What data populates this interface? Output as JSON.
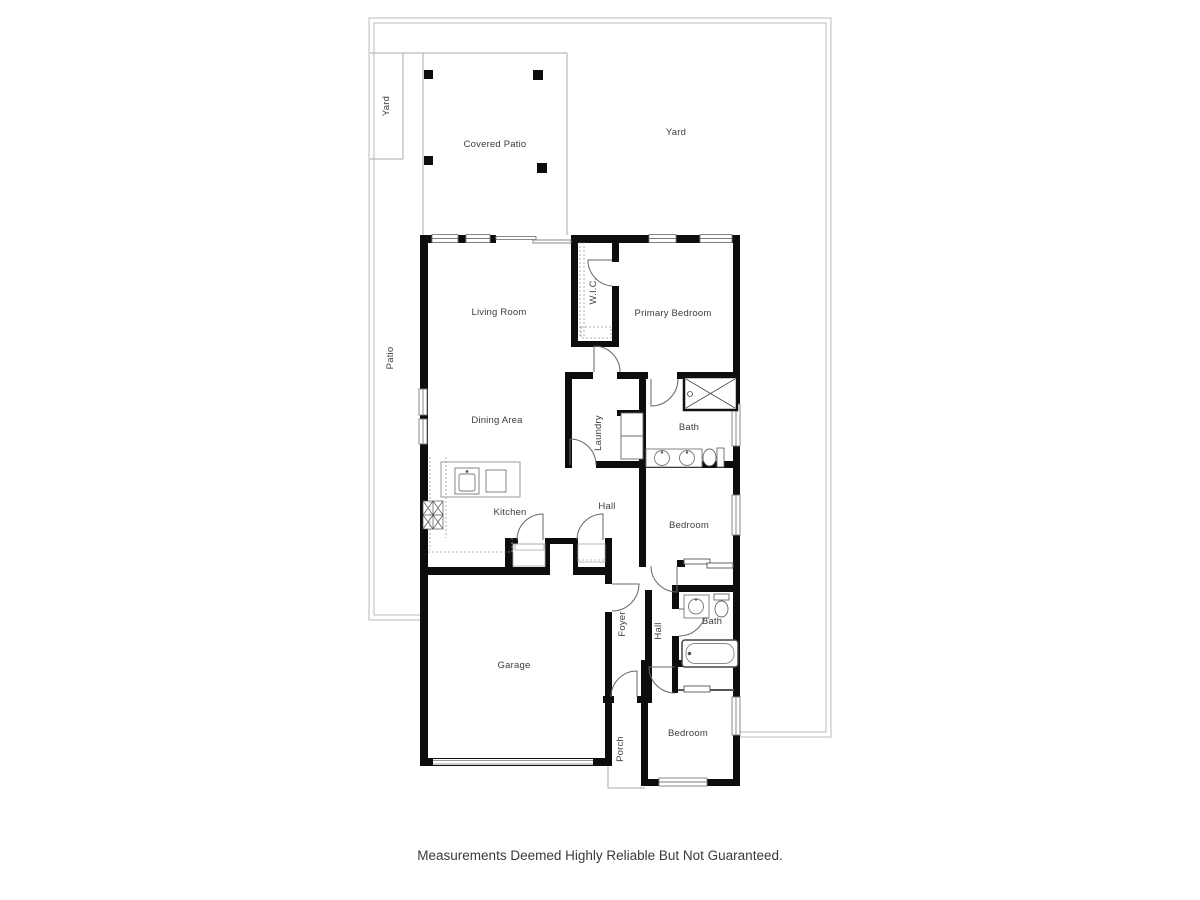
{
  "page": {
    "caption": "Measurements Deemed Highly Reliable But Not Guaranteed."
  },
  "colors": {
    "wall": "#0d0d0d",
    "boundary": "#b9b9b9",
    "fixture": "#666666",
    "label": "#3c3c3c"
  },
  "rooms": [
    {
      "id": "yard-side",
      "label": "Yard",
      "rotated": true
    },
    {
      "id": "yard-main",
      "label": "Yard",
      "rotated": false
    },
    {
      "id": "covered-patio",
      "label": "Covered Patio",
      "rotated": false
    },
    {
      "id": "patio",
      "label": "Patio",
      "rotated": true
    },
    {
      "id": "living-room",
      "label": "Living Room",
      "rotated": false
    },
    {
      "id": "wic",
      "label": "W.I.C.",
      "rotated": true
    },
    {
      "id": "primary-bedroom",
      "label": "Primary Bedroom",
      "rotated": false
    },
    {
      "id": "dining-area",
      "label": "Dining Area",
      "rotated": false
    },
    {
      "id": "laundry",
      "label": "Laundry",
      "rotated": true
    },
    {
      "id": "bath-primary",
      "label": "Bath",
      "rotated": false
    },
    {
      "id": "kitchen",
      "label": "Kitchen",
      "rotated": false
    },
    {
      "id": "hall-upper",
      "label": "Hall",
      "rotated": false
    },
    {
      "id": "bedroom-middle",
      "label": "Bedroom",
      "rotated": false
    },
    {
      "id": "garage",
      "label": "Garage",
      "rotated": false
    },
    {
      "id": "foyer",
      "label": "Foyer",
      "rotated": true
    },
    {
      "id": "hall-lower",
      "label": "Hall",
      "rotated": true
    },
    {
      "id": "bath-hall",
      "label": "Bath",
      "rotated": false
    },
    {
      "id": "porch",
      "label": "Porch",
      "rotated": true
    },
    {
      "id": "bedroom-bottom",
      "label": "Bedroom",
      "rotated": false
    }
  ]
}
